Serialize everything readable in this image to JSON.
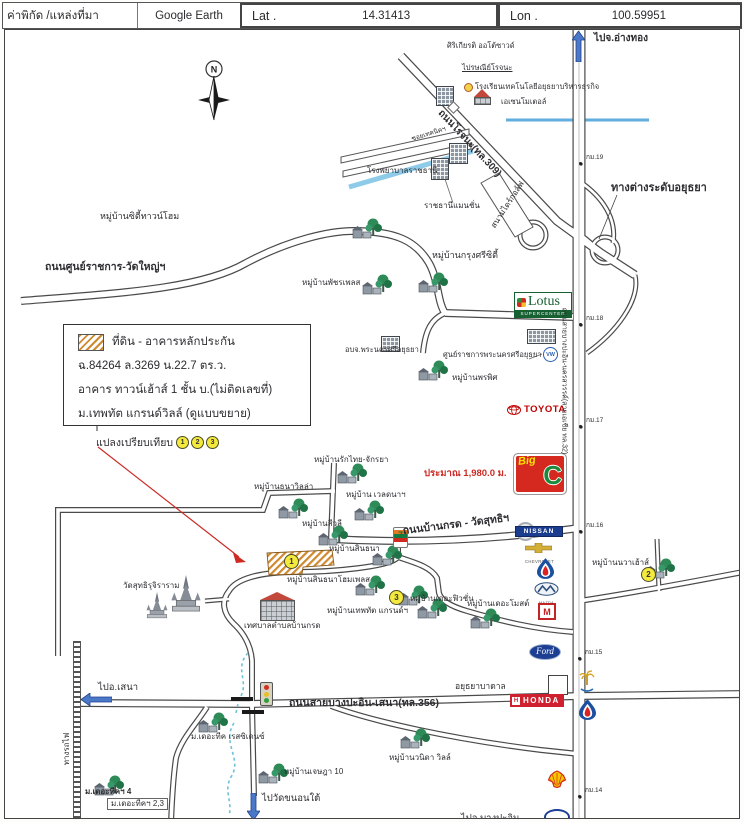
{
  "header": {
    "field_label": "ค่าพิกัด /แหล่งที่มา",
    "source": "Google Earth",
    "lat_label": "Lat .",
    "lat_value": "14.31413",
    "lon_label": "Lon .",
    "lon_value": "100.59951"
  },
  "legend": {
    "swatch_color": "#cf8a30",
    "title": "ที่ดิน - อาคารหลักประกัน",
    "deed": "ฉ.84264  ล.3269 น.22.7 ตร.ว.",
    "building": "อาคาร ทาวน์เฮ้าส์ 1 ชั้น บ.(ไม่ติดเลขที่)",
    "project": "ม.เทพทัต แกรนด์วิลล์ (ดูแบบขยาย)",
    "compare_label": "แปลงเปรียบเทียบ",
    "compare_markers": [
      "1",
      "2",
      "3"
    ]
  },
  "compass_label": "N",
  "map": {
    "accent_colors": {
      "water": "#6fb4dc",
      "road_casing": "#4a4a4a",
      "subject_hatch": "#cf8a30",
      "distance_red": "#cc2b24"
    },
    "labels": [
      {
        "name": "to-angthong-label",
        "text": "ไปจ.อ่างทอง",
        "x": 593,
        "y": 33,
        "fs": 10,
        "b": 1
      },
      {
        "name": "sirikiat-autosound-label",
        "text": "ศิริเกียรติ ออโต้ซาวด์",
        "x": 446,
        "y": 41,
        "fs": 7.5
      },
      {
        "name": "rojana-post-office-label",
        "text": "ไปรษณีย์โรจนะ",
        "x": 461,
        "y": 63,
        "fs": 7.5,
        "u": 1
      },
      {
        "name": "school-label",
        "text": "โรงเรียนเทคโนโลยีอยุธยาบริหารธุรกิจ",
        "x": 474,
        "y": 82,
        "fs": 7.5
      },
      {
        "name": "motel-label",
        "text": "เอเซนโมเตอล์",
        "x": 500,
        "y": 97,
        "fs": 7.5
      },
      {
        "name": "rojana-road-label",
        "text": "ถนนโรจนะ(ทล.309)",
        "x": 468,
        "y": 143,
        "fs": 10,
        "b": 1,
        "rot": 47,
        "ctr": 1
      },
      {
        "name": "soi-technic-label",
        "text": "ซอยเทคนิคฯ",
        "x": 428,
        "y": 134,
        "fs": 6.5,
        "rot": -17,
        "ctr": 1
      },
      {
        "name": "ratchathani-hospital-label",
        "text": "โรงพยาบาลราชธานี",
        "x": 366,
        "y": 166,
        "fs": 8
      },
      {
        "name": "ratchathani-mansion-label",
        "text": "ราชธานีแมนชั่น",
        "x": 423,
        "y": 201,
        "fs": 8
      },
      {
        "name": "golf-range-label",
        "text": "สนามไดร์กอล์ฟ",
        "x": 507,
        "y": 204,
        "fs": 8,
        "rot": -57,
        "ctr": 1
      },
      {
        "name": "interchange-label",
        "text": "ทางต่างระดับอยุธยา",
        "x": 610,
        "y": 182,
        "fs": 11,
        "b": 1
      },
      {
        "name": "km19-label",
        "text": "กม.19",
        "x": 585,
        "y": 154,
        "fs": 6.5,
        "dot": 1
      },
      {
        "name": "city-townhome-label",
        "text": "หมู่บ้านซิตี้ทาวน์โฮม",
        "x": 99,
        "y": 211,
        "fs": 9
      },
      {
        "name": "gov-center-road-label",
        "text": "ถนนศูนย์ราชการ-วัดใหญ่ฯ",
        "x": 44,
        "y": 261,
        "fs": 10.5,
        "b": 1
      },
      {
        "name": "krungsri-city-label",
        "text": "หมู่บ้านกรุงศรีซิตี้",
        "x": 431,
        "y": 250,
        "fs": 9
      },
      {
        "name": "patchara-place-label",
        "text": "หมู่บ้านพัชรเพลส",
        "x": 301,
        "y": 278,
        "fs": 8
      },
      {
        "name": "pao-ayutthaya-label",
        "text": "อบจ.พระนครศรีอยุธยา",
        "x": 344,
        "y": 345,
        "fs": 7.5
      },
      {
        "name": "gov-center-label",
        "text": "ศูนย์ราชการพระนครศรีอยุธยา",
        "x": 442,
        "y": 350,
        "fs": 7.5
      },
      {
        "name": "pornpis-village-label",
        "text": "หมู่บ้านพรพิศ",
        "x": 451,
        "y": 373,
        "fs": 8
      },
      {
        "name": "asia-road-label",
        "text": "ถนนสายบางปะอิน-นครสวรรค์(สายเอเชีย ทล.32)",
        "x": 563,
        "y": 380,
        "fs": 7,
        "rot": 90,
        "ctr": 1
      },
      {
        "name": "km18-label",
        "text": "กม.18",
        "x": 585,
        "y": 315,
        "fs": 6.5,
        "dot": 1
      },
      {
        "name": "km17-label",
        "text": "กม.17",
        "x": 585,
        "y": 417,
        "fs": 6.5,
        "dot": 1
      },
      {
        "name": "distance-label",
        "text": "ประมาณ 1,980.0 ม.",
        "x": 423,
        "y": 468,
        "fs": 9.5,
        "b": 1,
        "c": "#cc2b24"
      },
      {
        "name": "rakthai-village-label",
        "text": "หมู่บ้านรักไทย-จักรยา",
        "x": 313,
        "y": 455,
        "fs": 8
      },
      {
        "name": "thanavilla-village-label",
        "text": "หมู่บ้านธนาวิลล่า",
        "x": 253,
        "y": 482,
        "fs": 8
      },
      {
        "name": "waladna-village-label",
        "text": "หมู่บ้าน เวลดนาฯ",
        "x": 345,
        "y": 490,
        "fs": 8
      },
      {
        "name": "sivalee-village-label",
        "text": "หมู่บ้านสีวลี",
        "x": 301,
        "y": 519,
        "fs": 8
      },
      {
        "name": "bankrod-road-label",
        "text": "ถนนบ้านกรด - วัดสุทธิฯ",
        "x": 455,
        "y": 524,
        "fs": 10.5,
        "b": 1,
        "rot": -7,
        "ctr": 1
      },
      {
        "name": "sinthana-village-label",
        "text": "หมู่บ้านสินธนา",
        "x": 328,
        "y": 544,
        "fs": 8
      },
      {
        "name": "sinthana-homeplace-label",
        "text": "หมู่บ้านสินธนาโฮมเพลส",
        "x": 286,
        "y": 575,
        "fs": 8
      },
      {
        "name": "navahouse-village-label",
        "text": "หมู่บ้านนวาเฮ้าส์",
        "x": 591,
        "y": 558,
        "fs": 8
      },
      {
        "name": "fusion-village-label",
        "text": "หมู่บ้านเดอะฟิวชั่น",
        "x": 409,
        "y": 594,
        "fs": 8
      },
      {
        "name": "theppatat-grand-label",
        "text": "หมู่บ้านเทพทัต แกรนด์ฯ",
        "x": 326,
        "y": 606,
        "fs": 8
      },
      {
        "name": "themost-village-label",
        "text": "หมู่บ้านเดอะโมสต์",
        "x": 466,
        "y": 599,
        "fs": 8
      },
      {
        "name": "municipality-label",
        "text": "เทศบาลตำบลบ้านกรด",
        "x": 243,
        "y": 621,
        "fs": 8
      },
      {
        "name": "wat-sutthi-label",
        "text": "วัดสุทธิรุจิราราม",
        "x": 122,
        "y": 581,
        "fs": 8
      },
      {
        "name": "km16-label",
        "text": "กม.16",
        "x": 585,
        "y": 522,
        "fs": 6.5,
        "dot": 1
      },
      {
        "name": "ayutthaya-badan-label",
        "text": "อยุธยาบาดาล",
        "x": 454,
        "y": 681,
        "fs": 8.5
      },
      {
        "name": "km15-label",
        "text": "กม.15",
        "x": 584,
        "y": 649,
        "fs": 6.5,
        "dot": 1
      },
      {
        "name": "km14-label",
        "text": "กม.14",
        "x": 584,
        "y": 787,
        "fs": 6.5,
        "dot": 1
      },
      {
        "name": "to-sena-label",
        "text": "ไปอ.เสนา",
        "x": 97,
        "y": 682,
        "fs": 9.5
      },
      {
        "name": "sena-road-label",
        "text": "ถนนสายบางปะอิน-เสนา(ทล.356)",
        "x": 288,
        "y": 697,
        "fs": 10.5,
        "b": 1
      },
      {
        "name": "railway-label",
        "text": "ทางรถไฟ",
        "x": 66,
        "y": 748,
        "fs": 8,
        "rot": -90,
        "ctr": 1
      },
      {
        "name": "teak-residence-label",
        "text": "ม.เดอะทีค เรสซิเดนซ์",
        "x": 190,
        "y": 732,
        "fs": 8
      },
      {
        "name": "jessada-village-label",
        "text": "หมู่บ้านเจษฎา 10",
        "x": 283,
        "y": 767,
        "fs": 8
      },
      {
        "name": "wanida-ville-label",
        "text": "หมู่บ้านวนิดา วิลล์",
        "x": 388,
        "y": 753,
        "fs": 8
      },
      {
        "name": "teak4-label",
        "text": "ม.เดอะทีคฯ 4",
        "x": 84,
        "y": 787,
        "fs": 8,
        "b": 1
      },
      {
        "name": "teak23-label",
        "text": "ม.เดอะทีคฯ 2,3",
        "x": 106,
        "y": 797,
        "fs": 8,
        "box": 1
      },
      {
        "name": "to-wat-khanon-label",
        "text": "ไปวัดขนอนใต้",
        "x": 261,
        "y": 793,
        "fs": 9.5
      },
      {
        "name": "to-bangpain-label",
        "text": "ไปอ.บางปะอิน",
        "x": 460,
        "y": 813,
        "fs": 9.5
      }
    ],
    "badges": [
      {
        "n": "1",
        "x": 283,
        "y": 553,
        "d": 13
      },
      {
        "n": "2",
        "x": 640,
        "y": 566,
        "d": 13
      },
      {
        "n": "3",
        "x": 388,
        "y": 589,
        "d": 13
      }
    ],
    "villages": [
      [
        350,
        216
      ],
      [
        416,
        270
      ],
      [
        360,
        272
      ],
      [
        416,
        358
      ],
      [
        276,
        496
      ],
      [
        335,
        461
      ],
      [
        352,
        498
      ],
      [
        316,
        523
      ],
      [
        370,
        543
      ],
      [
        353,
        573
      ],
      [
        396,
        583
      ],
      [
        415,
        596
      ],
      [
        468,
        606
      ],
      [
        643,
        556
      ],
      [
        196,
        710
      ],
      [
        256,
        761
      ],
      [
        398,
        726
      ],
      [
        92,
        773
      ]
    ],
    "temples": [
      {
        "name": "wat-sutthi-temple-icon",
        "x": 168,
        "y": 574,
        "s": 34
      },
      {
        "name": "wat-sutthi-temple-icon-small",
        "x": 144,
        "y": 591,
        "s": 24
      }
    ],
    "buildings": [
      {
        "type": "grid",
        "x": 435,
        "y": 85,
        "w": 16,
        "h": 18
      },
      {
        "type": "grid",
        "x": 448,
        "y": 142,
        "w": 17,
        "h": 19
      },
      {
        "type": "grid",
        "x": 430,
        "y": 157,
        "w": 16,
        "h": 20
      },
      {
        "type": "grid",
        "x": 526,
        "y": 328,
        "w": 27,
        "h": 13
      },
      {
        "type": "grid",
        "x": 380,
        "y": 335,
        "w": 17,
        "h": 14
      },
      {
        "type": "redroof",
        "x": 473,
        "y": 88,
        "w": 17,
        "h": 14
      },
      {
        "type": "redroof",
        "x": 259,
        "y": 591,
        "w": 35,
        "h": 27
      }
    ],
    "logos": [
      {
        "name": "lotus-logo",
        "type": "lotus",
        "x": 513,
        "y": 291,
        "text": "Lotus",
        "subtext": "SUPERCENTER"
      },
      {
        "name": "bigc-logo",
        "type": "bigc",
        "x": 512,
        "y": 452,
        "text": "Big",
        "subtext": "C"
      },
      {
        "name": "toyota-logo",
        "type": "toyota",
        "x": 506,
        "y": 403,
        "text": "TOYOTA"
      },
      {
        "name": "nissan-logo",
        "type": "nissan",
        "x": 514,
        "y": 521,
        "text": "NISSAN"
      },
      {
        "name": "chevrolet-logo",
        "type": "chevrolet",
        "x": 524,
        "y": 539,
        "text": "CHEVROLET"
      },
      {
        "name": "ptt-logo",
        "type": "ptt",
        "x": 536,
        "y": 557
      },
      {
        "name": "mazda-logo",
        "type": "mazda",
        "x": 533,
        "y": 581,
        "text": "MAZDA"
      },
      {
        "name": "m-logo",
        "type": "mlogo",
        "x": 537,
        "y": 602,
        "text": "M"
      },
      {
        "name": "ford-logo",
        "type": "ford",
        "x": 528,
        "y": 643,
        "text": "Ford"
      },
      {
        "name": "vw-logo",
        "type": "vw",
        "x": 542,
        "y": 346,
        "text": "VW"
      },
      {
        "name": "honda-logo",
        "type": "honda",
        "x": 509,
        "y": 693,
        "text": "HONDA",
        "subtext": "H"
      },
      {
        "name": "shell-logo",
        "type": "shell",
        "x": 546,
        "y": 769
      },
      {
        "name": "ptt-station-logo",
        "type": "ptt",
        "x": 578,
        "y": 698
      },
      {
        "name": "palm-tree-icon",
        "type": "palm",
        "x": 578,
        "y": 668
      },
      {
        "name": "blue-oval-logo",
        "type": "oval",
        "x": 543,
        "y": 808
      },
      {
        "name": "seven-eleven-logo",
        "type": "seven",
        "x": 392,
        "y": 526,
        "text": "7"
      }
    ],
    "misc_icons": [
      {
        "name": "traffic-light-icon",
        "type": "tlight",
        "x": 259,
        "y": 681
      },
      {
        "name": "railway-crossing-icon",
        "type": "diamond",
        "x": 448,
        "y": 102
      },
      {
        "name": "school-badge-icon",
        "type": "dotbadge",
        "x": 463,
        "y": 82
      },
      {
        "name": "white-box-icon",
        "type": "whitebox",
        "x": 547,
        "y": 674,
        "w": 18,
        "h": 18
      }
    ],
    "arrows": [
      {
        "name": "to-angthong-arrow",
        "dir": "up",
        "x": 571,
        "y": 30,
        "len": 22
      },
      {
        "name": "to-sena-arrow",
        "dir": "left",
        "x": 80,
        "y": 692,
        "len": 22
      },
      {
        "name": "to-wat-khanon-arrow",
        "dir": "down",
        "x": 246,
        "y": 792,
        "len": 18
      }
    ]
  }
}
